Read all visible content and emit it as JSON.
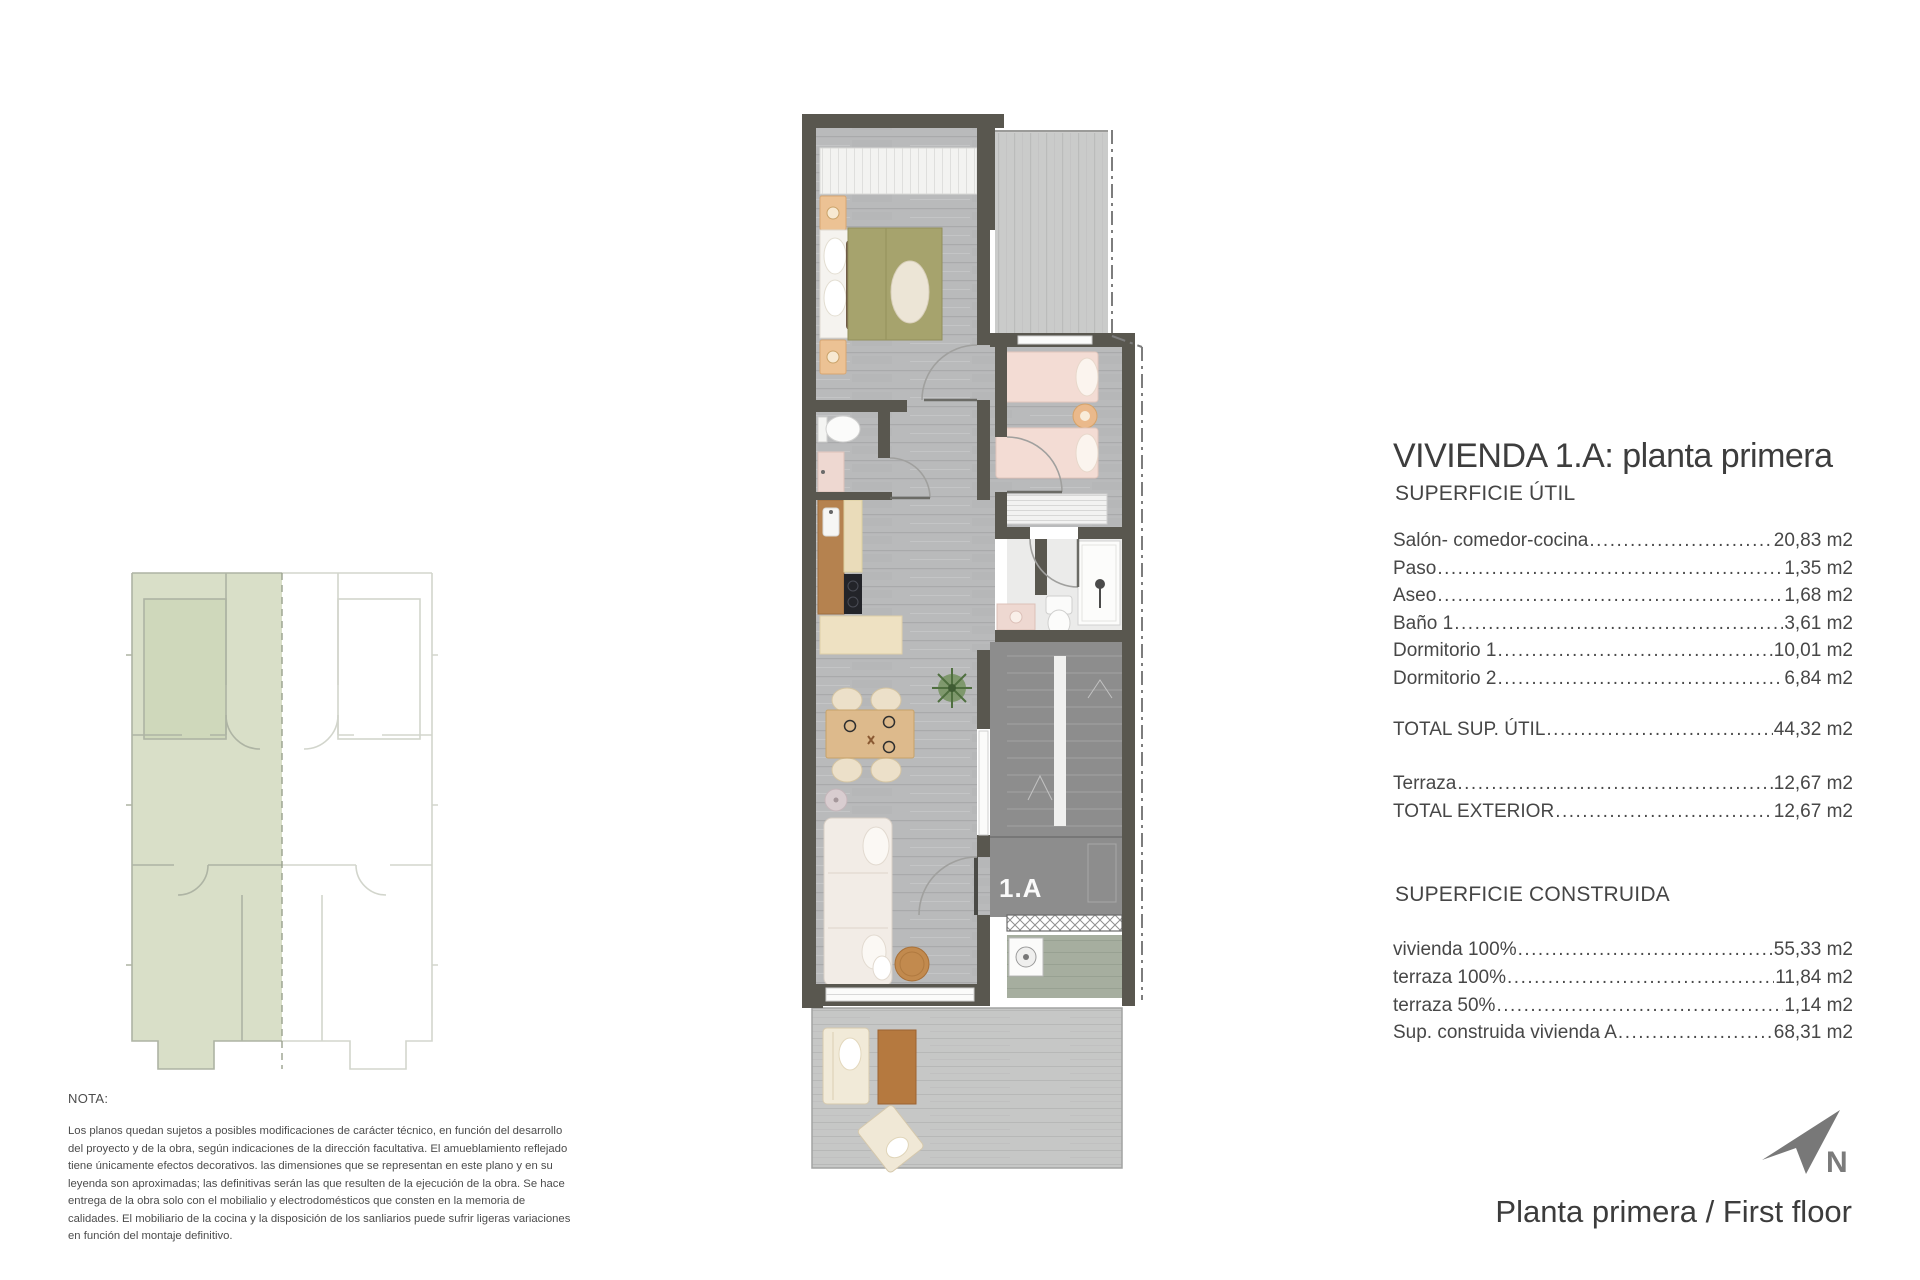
{
  "plan": {
    "unit_label": "1.A"
  },
  "info": {
    "title": "VIVIENDA 1.A: planta primera",
    "util": {
      "heading": "SUPERFICIE ÚTIL",
      "rows": [
        {
          "label": "Salón- comedor-cocina",
          "value": "20,83 m2"
        },
        {
          "label": "Paso",
          "value": "1,35 m2"
        },
        {
          "label": "Aseo",
          "value": "1,68 m2"
        },
        {
          "label": "Baño 1",
          "value": "3,61 m2"
        },
        {
          "label": "Dormitorio 1",
          "value": "10,01 m2"
        },
        {
          "label": "Dormitorio 2",
          "value": "6,84 m2"
        }
      ],
      "total": {
        "label": "TOTAL SUP. ÚTIL",
        "value": "44,32 m2"
      }
    },
    "exterior": {
      "rows": [
        {
          "label": "Terraza",
          "value": "12,67 m2"
        },
        {
          "label": "TOTAL EXTERIOR",
          "value": "12,67 m2"
        }
      ]
    },
    "construida": {
      "heading": "SUPERFICIE CONSTRUIDA",
      "rows": [
        {
          "label": "vivienda 100% ",
          "value": "55,33 m2"
        },
        {
          "label": "terraza 100%",
          "value": "11,84 m2"
        },
        {
          "label": "terraza 50%",
          "value": "1,14 m2"
        },
        {
          "label": "Sup. construida vivienda A",
          "value": "68,31 m2"
        }
      ]
    }
  },
  "nota": {
    "heading": "NOTA:",
    "body": "Los planos quedan sujetos a posibles modificaciones de carácter técnico, en función del desarrollo del proyecto y de la obra, según indicaciones de la dirección facultativa. El amueblamiento reflejado tiene únicamente efectos decorativos. las dimensiones que se representan en este plano y en su leyenda son aproximadas; las definitivas serán las que resulten de la ejecución de la obra. Se hace entrega de la obra solo con el mobilialio y electrodomésticos que consten en la memoria de calidades. El mobiliario de la cocina y la disposición de los sanliarios puede sufrir ligeras variaciones en función del montaje definitivo."
  },
  "footer": {
    "caption": "Planta primera / First floor",
    "north_label": "N"
  },
  "colors": {
    "wall": "#59574f",
    "floor": "#b9babb",
    "terrace": "#c8c9c8",
    "key_plan_highlight": "#d9dfc8",
    "stairs": "#8d8d8d",
    "bed_olive": "#a6a36d",
    "bed_pink": "#f3dcd4"
  }
}
